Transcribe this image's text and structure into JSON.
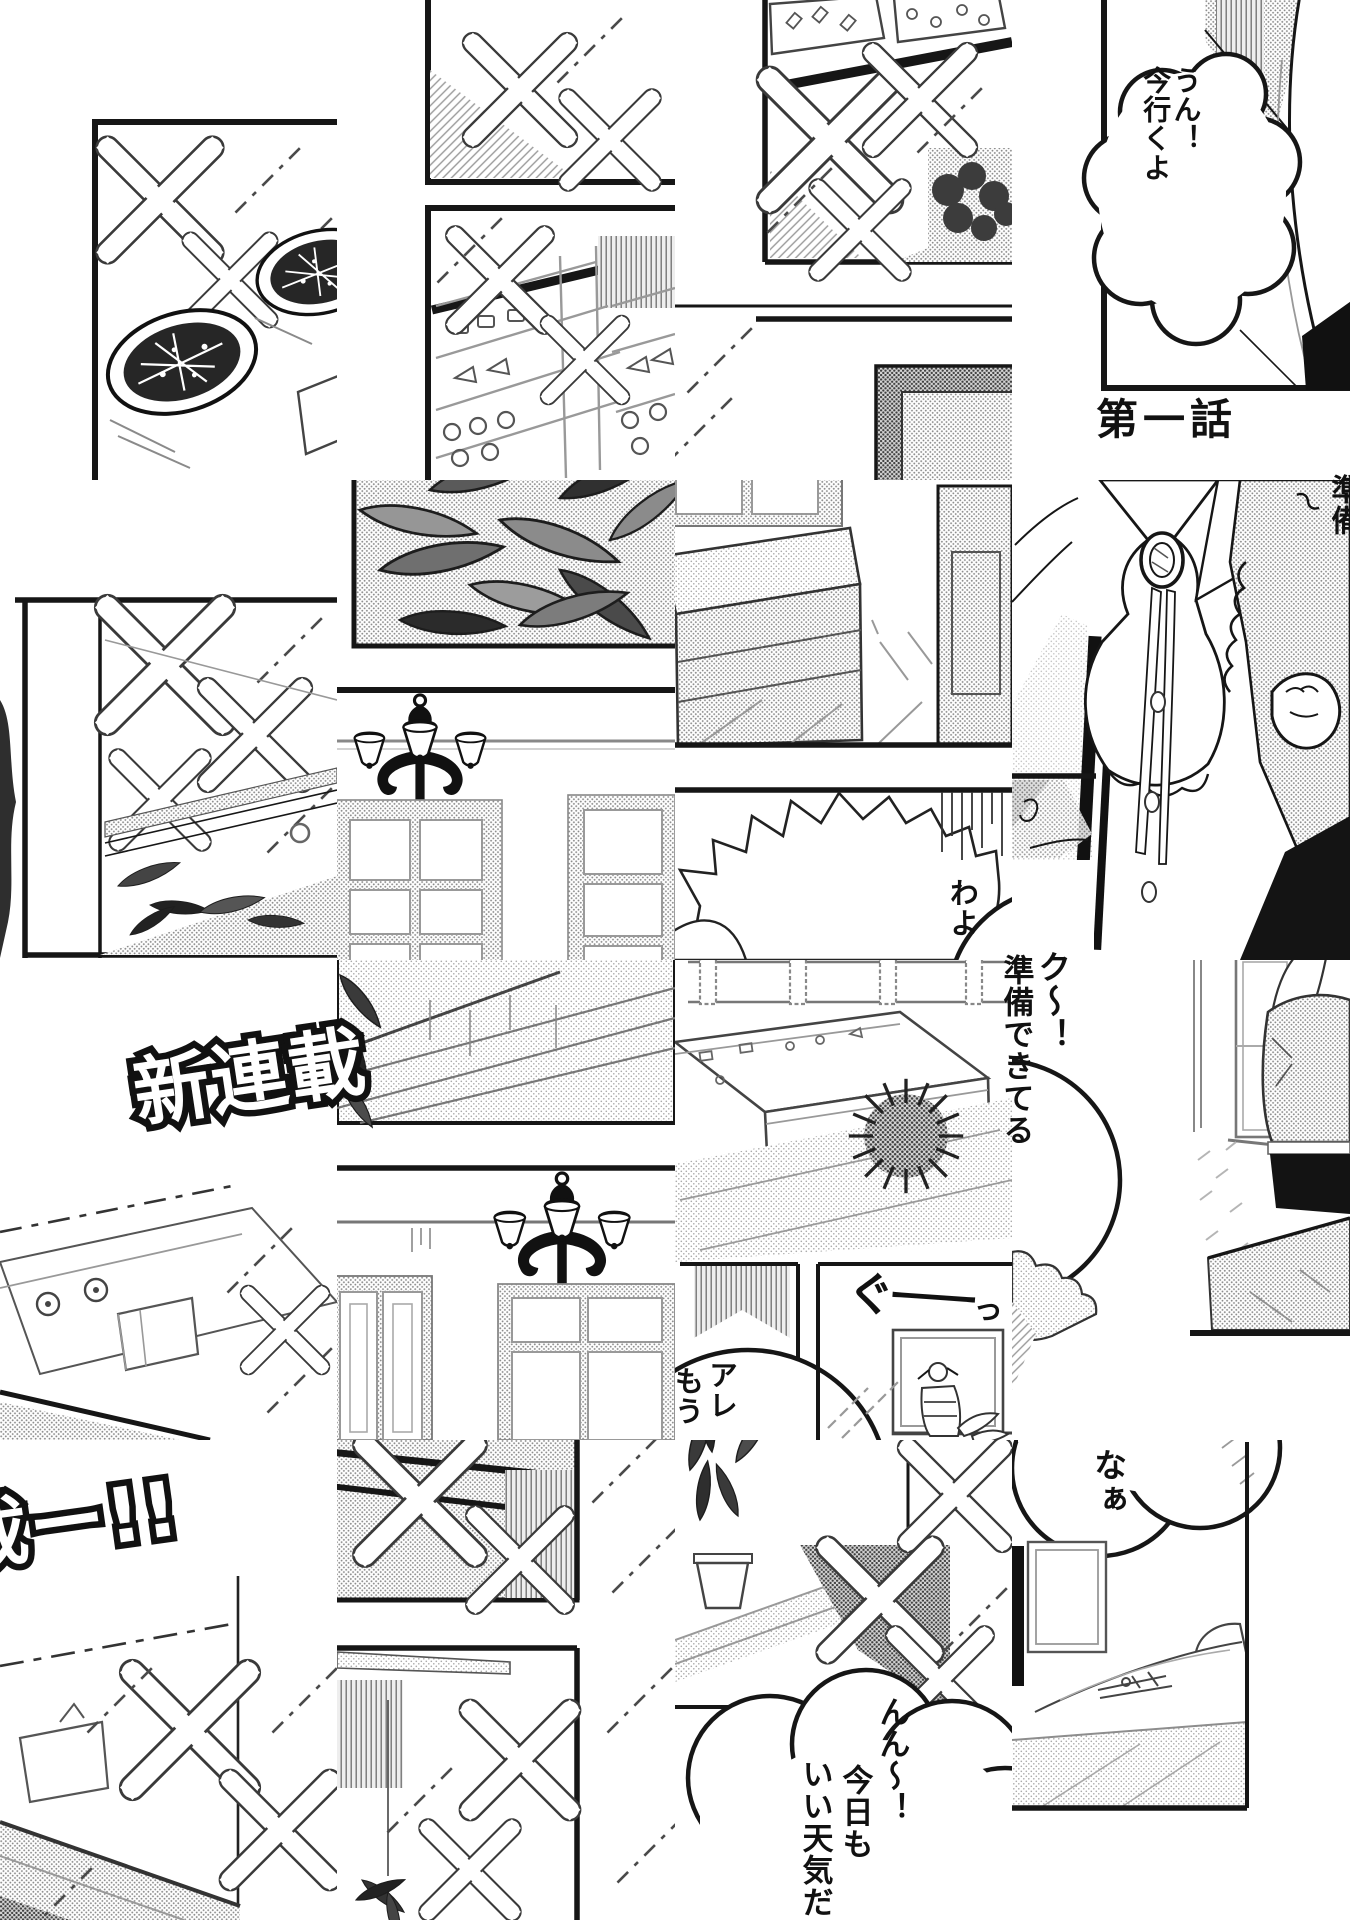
{
  "page": {
    "kind": "scrambled-manga-page",
    "title": {
      "chapter": "第一話"
    },
    "banner": {
      "part1": "新連載",
      "part2": "載ー!!"
    },
    "speech": {
      "bubble_going": {
        "lines": [
          "うん！",
          "今行くよ"
        ]
      },
      "bubble_wayo": "わよ",
      "knock": {
        "col1": "ク〜！",
        "col2": "準備できてる"
      },
      "edge_fragment": {
        "squiggle": "〜",
        "clipped": "準備"
      },
      "bubble_are": {
        "col1": "アレ",
        "col2": "もう"
      },
      "sfx_guu": {
        "start": "ぐ",
        "dash": "ー",
        "end": "っ"
      },
      "bubble_naa": "なぁ",
      "bubble_weather": {
        "col1": "んん〜！",
        "col2": "今日も",
        "col3": "いい天気だ"
      }
    },
    "colors": {
      "ink": "#161616",
      "paper": "#ffffff",
      "tone": "#c9c9c9"
    }
  }
}
